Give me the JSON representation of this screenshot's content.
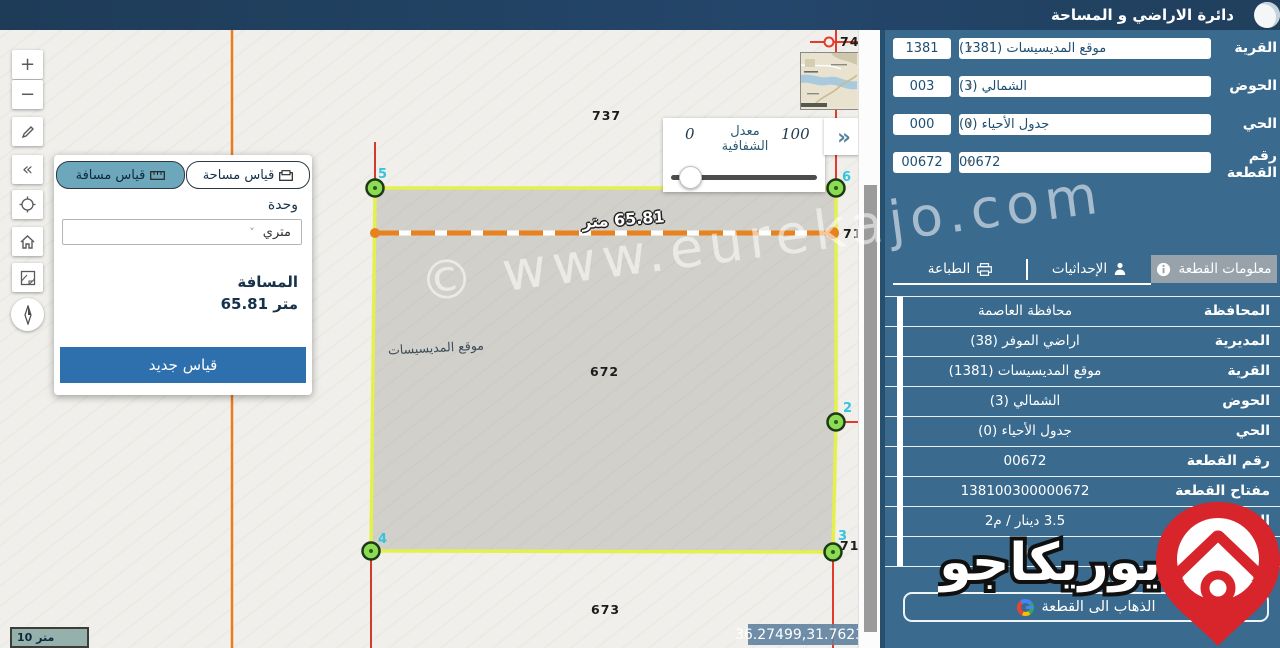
{
  "header": {
    "title": "دائرة الاراضي و المساحة"
  },
  "filters": [
    {
      "label": "القرية",
      "value": "موقع المديسيسات (1381)",
      "code": "1381"
    },
    {
      "label": "الحوض",
      "value": "الشمالي (3)",
      "code": "003"
    },
    {
      "label": "الحي",
      "value": "جدول الأحياء (0)",
      "code": "000"
    },
    {
      "label": "رقم القطعة",
      "value": "00672",
      "code": "00672"
    }
  ],
  "sidebar": {
    "tabs": [
      {
        "label": "معلومات القطعة",
        "icon": "info-icon",
        "active": true
      },
      {
        "label": "الإحداثيات",
        "icon": "person-pin-icon",
        "active": false
      },
      {
        "label": "الطباعة",
        "icon": "printer-icon",
        "active": false
      }
    ],
    "info_rows": [
      {
        "label": "المحافظة",
        "value": "محافظة العاصمة"
      },
      {
        "label": "المديرية",
        "value": "اراضي الموفر (38)"
      },
      {
        "label": "القرية",
        "value": "موقع المديسيسات (1381)"
      },
      {
        "label": "الحوض",
        "value": "الشمالي (3)"
      },
      {
        "label": "الحي",
        "value": "جدول الأحياء (0)"
      },
      {
        "label": "رقم القطعة",
        "value": "00672"
      },
      {
        "label": "مفتاح القطعة",
        "value": "138100300000672"
      },
      {
        "label": "السعر",
        "value": "3.5 دينار / م2"
      },
      {
        "label": "**السعر المقدر",
        "value": "4"
      }
    ],
    "disclaimer": "**المعلومات المعروضة ليست قانونية",
    "go_button": "الذهاب الى القطعة"
  },
  "measure_panel": {
    "tab_distance": "قياس مسافة",
    "tab_area": "قياس مساحة",
    "unit_label": "وحدة",
    "unit_value": "متري",
    "distance_label": "المسافة",
    "distance_value": "متر 65.81",
    "new_measure_button": "قياس جديد"
  },
  "transparency": {
    "label_line1": "معدل",
    "label_line2": "الشفافية",
    "min": "0",
    "max": "100"
  },
  "map": {
    "parcel_labels": [
      {
        "text": "746"
      },
      {
        "text": "737"
      },
      {
        "text": "710"
      },
      {
        "text": "672"
      },
      {
        "text": "711"
      },
      {
        "text": "673"
      }
    ],
    "vertex_labels": [
      "5",
      "6",
      "2",
      "3",
      "4"
    ],
    "measurement_label": "65.81 متر",
    "place_name": "موقع المديسيسات",
    "coordinates": "36.27499,31.76235",
    "scale": "10 متر"
  },
  "watermark": {
    "site": "© www.eurekajo.com",
    "brand": "يوريكاجو"
  },
  "icons": {
    "chevrons_right": "»",
    "collapse": "«",
    "zoom_in": "+",
    "zoom_out": "−",
    "dropdown": "▾",
    "select_chevron": "˅"
  },
  "colors": {
    "header": "#203f5d",
    "sidebar": "#3a6b8f",
    "active_tab": "#97a2aa",
    "parcel_stroke": "#e4f14d",
    "vertex_fill": "#8bdc52",
    "measure_line": "#e8821e",
    "red_line": "#e23b2b",
    "accent_button": "#2e6fad",
    "brand_red": "#d8242b"
  }
}
